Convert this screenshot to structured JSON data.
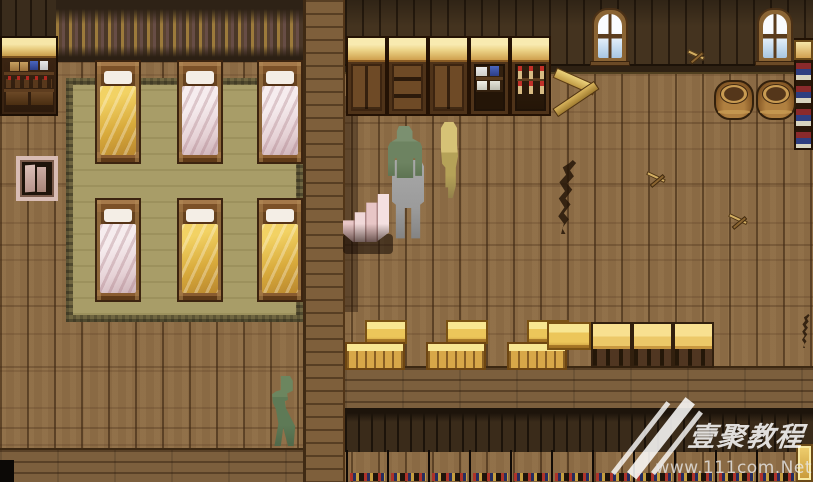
{
  "meta": {
    "scene_title": "tavern-dormitory-interior",
    "width": 813,
    "height": 482
  },
  "palette": {
    "floor": "#8a6a44",
    "wall": "#44331f",
    "mat": "#a89d68",
    "gold": "#ecc65a",
    "blanket-yellow": "#ecc44e",
    "blanket-white": "#f2e6e8",
    "green": "#6d8361",
    "gray": "#9b9b9b",
    "tan": "#b5a258",
    "wm": "#ffffff"
  },
  "watermark": {
    "title": "壹聚教程",
    "url": "www.111com.Net"
  },
  "regions": [
    {
      "name": "bedroom-wall-left",
      "kind": "darkwall",
      "x": 0,
      "y": 0,
      "w": 58,
      "h": 40,
      "i": false
    },
    {
      "name": "bedroom-tapestry-wall",
      "kind": "tapestry",
      "x": 56,
      "y": 0,
      "w": 247,
      "h": 62,
      "i": false
    },
    {
      "name": "hall-back-wall",
      "kind": "hallwall",
      "x": 345,
      "y": 0,
      "w": 468,
      "h": 66,
      "i": false
    },
    {
      "name": "hall-baseboard",
      "kind": "baseboard",
      "x": 345,
      "y": 64,
      "w": 468,
      "h": 10,
      "i": false
    },
    {
      "name": "dormitory-mat",
      "kind": "mat",
      "x": 66,
      "y": 78,
      "w": 237,
      "h": 244,
      "i": false
    },
    {
      "name": "ledge-band",
      "kind": "ledge",
      "x": 345,
      "y": 366,
      "w": 468,
      "h": 44,
      "i": false
    },
    {
      "name": "lower-back-wall",
      "kind": "bottomwall",
      "x": 345,
      "y": 408,
      "w": 468,
      "h": 44,
      "i": false
    },
    {
      "name": "bottom-left-wallband",
      "kind": "bottomband",
      "x": 0,
      "y": 448,
      "w": 303,
      "h": 34,
      "i": false
    },
    {
      "name": "dividing-wall-column",
      "kind": "column",
      "x": 303,
      "y": 0,
      "w": 42,
      "h": 482,
      "i": false
    },
    {
      "name": "column-shadow",
      "kind": "shadow",
      "x": 345,
      "y": 96,
      "w": 13,
      "h": 216,
      "i": false
    },
    {
      "name": "stairs-shadow",
      "kind": "stairshadow",
      "x": 343,
      "y": 234,
      "w": 50,
      "h": 20,
      "i": false
    },
    {
      "name": "corner-dark",
      "kind": "corner",
      "x": 0,
      "y": 460,
      "w": 14,
      "h": 22,
      "i": false
    }
  ],
  "entities": [
    {
      "name": "bed-1",
      "type": "bed",
      "variant": "yellow",
      "x": 95,
      "y": 60,
      "w": 46,
      "h": 104,
      "i": true
    },
    {
      "name": "bed-2",
      "type": "bed",
      "variant": "white",
      "x": 177,
      "y": 60,
      "w": 46,
      "h": 104,
      "i": true
    },
    {
      "name": "bed-3",
      "type": "bed",
      "variant": "white",
      "x": 257,
      "y": 60,
      "w": 46,
      "h": 104,
      "i": true
    },
    {
      "name": "bed-4",
      "type": "bed",
      "variant": "white",
      "x": 95,
      "y": 198,
      "w": 46,
      "h": 104,
      "i": true
    },
    {
      "name": "bed-5",
      "type": "bed",
      "variant": "yellow",
      "x": 177,
      "y": 198,
      "w": 46,
      "h": 104,
      "i": true
    },
    {
      "name": "bed-6",
      "type": "bed",
      "variant": "yellow",
      "x": 257,
      "y": 198,
      "w": 46,
      "h": 104,
      "i": true
    },
    {
      "name": "potion-shelf",
      "type": "pshelf",
      "x": 0,
      "y": 36,
      "w": 58,
      "h": 80,
      "i": true
    },
    {
      "name": "floor-hatch",
      "type": "niche",
      "x": 16,
      "y": 156,
      "w": 42,
      "h": 45,
      "i": true
    },
    {
      "name": "cabinet-doors-1",
      "type": "cabinet",
      "variant": "doors",
      "x": 346,
      "y": 36,
      "w": 41,
      "h": 80,
      "i": true
    },
    {
      "name": "cabinet-drawers",
      "type": "cabinet",
      "variant": "drawers",
      "x": 387,
      "y": 36,
      "w": 41,
      "h": 80,
      "i": true
    },
    {
      "name": "cabinet-doors-2",
      "type": "cabinet",
      "variant": "doors",
      "x": 428,
      "y": 36,
      "w": 41,
      "h": 80,
      "i": true
    },
    {
      "name": "cabinet-dishes",
      "type": "cabinet",
      "variant": "dishes",
      "x": 469,
      "y": 36,
      "w": 41,
      "h": 80,
      "i": true
    },
    {
      "name": "cabinet-bottles",
      "type": "cabinet",
      "variant": "bottles",
      "x": 510,
      "y": 36,
      "w": 41,
      "h": 80,
      "i": true
    },
    {
      "name": "window-1",
      "type": "window",
      "x": 592,
      "y": 8,
      "w": 36,
      "h": 56,
      "i": false
    },
    {
      "name": "window-2",
      "type": "window",
      "x": 757,
      "y": 8,
      "w": 36,
      "h": 56,
      "i": false
    },
    {
      "name": "bookshelf-right",
      "type": "bookshelf",
      "x": 794,
      "y": 38,
      "w": 19,
      "h": 112,
      "i": true
    },
    {
      "name": "firewood-pile",
      "type": "firewood",
      "x": 551,
      "y": 66,
      "w": 52,
      "h": 58,
      "i": true
    },
    {
      "name": "barrel-1",
      "type": "barrel",
      "x": 714,
      "y": 80,
      "w": 40,
      "h": 40,
      "i": true
    },
    {
      "name": "barrel-2",
      "type": "barrel",
      "x": 756,
      "y": 80,
      "w": 40,
      "h": 40,
      "i": true
    },
    {
      "name": "wall-debris",
      "type": "debris",
      "x": 684,
      "y": 44,
      "w": 26,
      "h": 22,
      "i": false
    },
    {
      "name": "floor-crack-1",
      "type": "crack",
      "x": 556,
      "y": 160,
      "w": 28,
      "h": 74,
      "i": false
    },
    {
      "name": "floor-crack-2",
      "type": "crack",
      "x": 801,
      "y": 314,
      "w": 12,
      "h": 34,
      "i": false
    },
    {
      "name": "floor-debris-1",
      "type": "debris",
      "x": 643,
      "y": 164,
      "w": 28,
      "h": 28,
      "i": false
    },
    {
      "name": "floor-debris-2",
      "type": "debris",
      "x": 725,
      "y": 206,
      "w": 28,
      "h": 28,
      "i": false
    },
    {
      "name": "stairs",
      "type": "stairs",
      "x": 343,
      "y": 194,
      "w": 46,
      "h": 48,
      "i": true
    },
    {
      "name": "crate-stack-1",
      "type": "cratestack",
      "x": 345,
      "y": 320,
      "w": 64,
      "h": 50,
      "i": true
    },
    {
      "name": "crate-stack-2",
      "type": "cratestack",
      "x": 426,
      "y": 320,
      "w": 64,
      "h": 50,
      "i": true
    },
    {
      "name": "crate-stack-3",
      "type": "cratestack",
      "x": 507,
      "y": 320,
      "w": 64,
      "h": 50,
      "i": true
    },
    {
      "name": "crate-single",
      "type": "cratelid",
      "x": 547,
      "y": 322,
      "w": 44,
      "h": 28,
      "i": true
    },
    {
      "name": "table-1",
      "type": "table",
      "x": 591,
      "y": 322,
      "w": 41,
      "h": 46,
      "i": true
    },
    {
      "name": "table-2",
      "type": "table",
      "x": 632,
      "y": 322,
      "w": 41,
      "h": 46,
      "i": true
    },
    {
      "name": "table-3",
      "type": "table",
      "x": 673,
      "y": 322,
      "w": 41,
      "h": 46,
      "i": true
    },
    {
      "name": "counter-1",
      "type": "counter",
      "x": 346,
      "y": 450,
      "w": 41,
      "h": 32,
      "i": true
    },
    {
      "name": "counter-2",
      "type": "counter",
      "x": 387,
      "y": 450,
      "w": 41,
      "h": 32,
      "i": true
    },
    {
      "name": "counter-3",
      "type": "counter",
      "x": 428,
      "y": 450,
      "w": 41,
      "h": 32,
      "i": true
    },
    {
      "name": "counter-4",
      "type": "counter",
      "x": 469,
      "y": 450,
      "w": 41,
      "h": 32,
      "i": true
    },
    {
      "name": "counter-5",
      "type": "counter",
      "x": 510,
      "y": 450,
      "w": 41,
      "h": 32,
      "i": true
    },
    {
      "name": "counter-6",
      "type": "counter",
      "x": 551,
      "y": 450,
      "w": 41,
      "h": 32,
      "i": true
    },
    {
      "name": "counter-7",
      "type": "counter",
      "x": 592,
      "y": 450,
      "w": 41,
      "h": 32,
      "i": true
    },
    {
      "name": "counter-8",
      "type": "counter",
      "x": 633,
      "y": 450,
      "w": 41,
      "h": 32,
      "i": true
    },
    {
      "name": "counter-9",
      "type": "counter",
      "x": 674,
      "y": 450,
      "w": 41,
      "h": 32,
      "i": true
    },
    {
      "name": "counter-10",
      "type": "counter",
      "x": 715,
      "y": 450,
      "w": 41,
      "h": 32,
      "i": true
    },
    {
      "name": "counter-11",
      "type": "counter",
      "x": 756,
      "y": 450,
      "w": 41,
      "h": 32,
      "i": true
    },
    {
      "name": "corner-shelf",
      "type": "cornershelf",
      "x": 796,
      "y": 444,
      "w": 17,
      "h": 38,
      "i": true
    },
    {
      "name": "npc-porter",
      "type": "npc-gray",
      "x": 392,
      "y": 160,
      "w": 32,
      "h": 80,
      "i": true
    },
    {
      "name": "npc-hooded",
      "type": "npc-green",
      "x": 388,
      "y": 126,
      "w": 34,
      "h": 52,
      "i": true
    },
    {
      "name": "npc-slim",
      "type": "npc-tan",
      "x": 440,
      "y": 122,
      "w": 18,
      "h": 76,
      "i": true
    },
    {
      "name": "npc-walker",
      "type": "npc-walker",
      "x": 264,
      "y": 376,
      "w": 40,
      "h": 70,
      "i": true
    }
  ]
}
